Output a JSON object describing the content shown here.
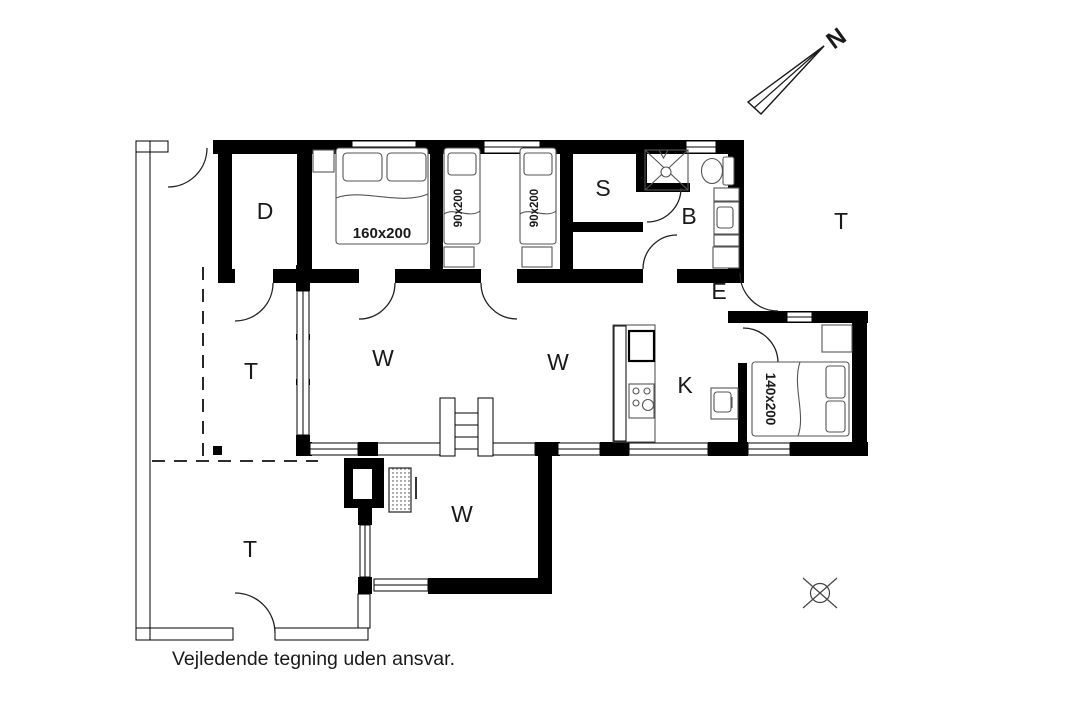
{
  "caption": "Vejledende tegning uden ansvar.",
  "north": {
    "label": "N"
  },
  "rooms": {
    "d": {
      "label": "D"
    },
    "s": {
      "label": "S"
    },
    "b": {
      "label": "B"
    },
    "e": {
      "label": "E"
    },
    "k": {
      "label": "K"
    },
    "w_living_west": {
      "label": "W"
    },
    "w_living_east": {
      "label": "W"
    },
    "w_sunroom": {
      "label": "W"
    },
    "t_east": {
      "label": "T"
    },
    "t_west": {
      "label": "T"
    },
    "t_south": {
      "label": "T"
    }
  },
  "beds": {
    "double_master": {
      "label": "160x200"
    },
    "single_left": {
      "label": "90x200"
    },
    "single_right": {
      "label": "90x200"
    },
    "double_small": {
      "label": "140x200"
    }
  },
  "colors": {
    "wall": "#000000",
    "furniture_line": "#555555",
    "text": "#1a1a1a",
    "background": "#ffffff"
  }
}
